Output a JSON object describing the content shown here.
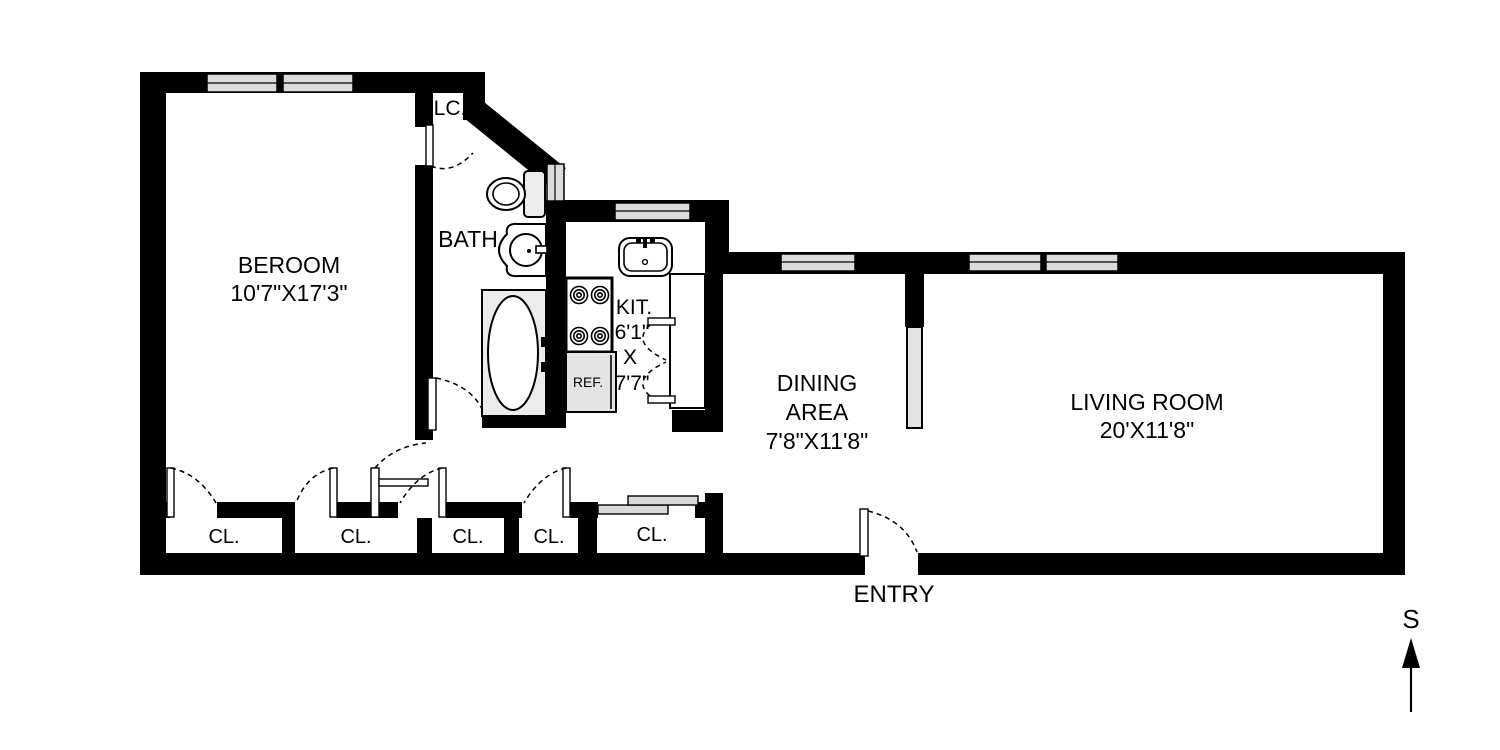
{
  "floorplan": {
    "bedroom": {
      "name": "BEROOM",
      "dims": "10'7\"X17'3\""
    },
    "linen_closet": {
      "label": "LC."
    },
    "bath": {
      "label": "BATH"
    },
    "kitchen": {
      "label": "KIT.",
      "dim_width": "6'1\"",
      "dim_sep": "X",
      "dim_depth": "7'7\""
    },
    "dining": {
      "line1": "DINING",
      "line2": "AREA",
      "dims": "7'8\"X11'8\""
    },
    "living": {
      "name": "LIVING ROOM",
      "dims": "20'X11'8\""
    },
    "entry": {
      "label": "ENTRY"
    },
    "refrigerator": {
      "label": "REF."
    },
    "closets": {
      "labels": [
        "CL.",
        "CL.",
        "CL.",
        "CL.",
        "CL."
      ]
    },
    "compass": {
      "label": "S"
    },
    "colors": {
      "wall": "#000000",
      "window_fill": "#dcdcdc",
      "fixture_gray": "#e4e4e4",
      "background": "#ffffff"
    }
  }
}
